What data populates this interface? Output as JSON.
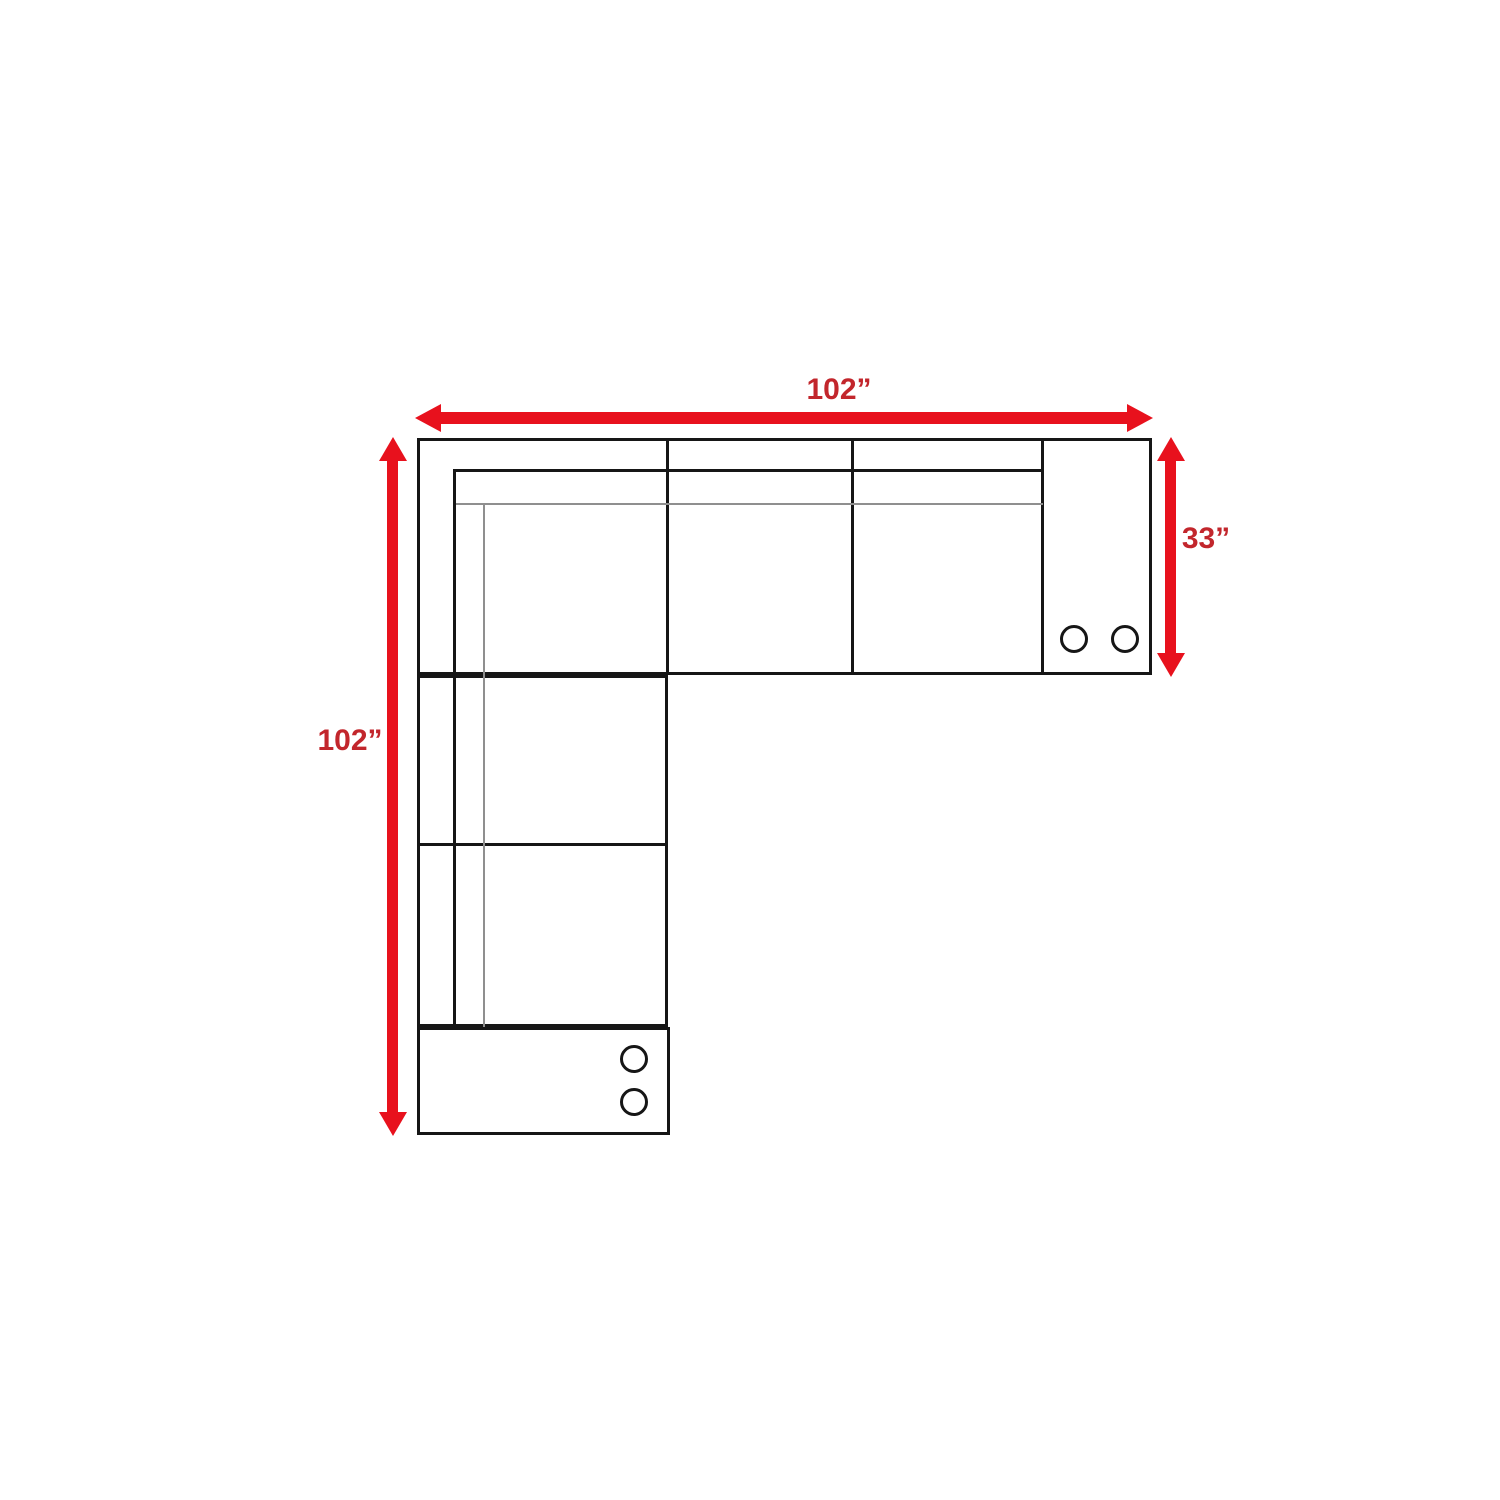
{
  "diagram": {
    "title": "sectional-sofa-dimension-floor-plan",
    "dimensions": {
      "top_width": "102”",
      "left_height": "102”",
      "right_depth": "33”"
    },
    "sofa": {
      "top_row_seat_count": 3,
      "left_column_seat_count": 2,
      "right_console_cup_holder_count": 2,
      "bottom_console_cup_holder_count": 2
    },
    "colors": {
      "arrow_red": "#e8111d",
      "label_red": "#c2262c",
      "line_black": "#161616",
      "line_gray": "#8f8f8f",
      "background": "#ffffff"
    }
  }
}
